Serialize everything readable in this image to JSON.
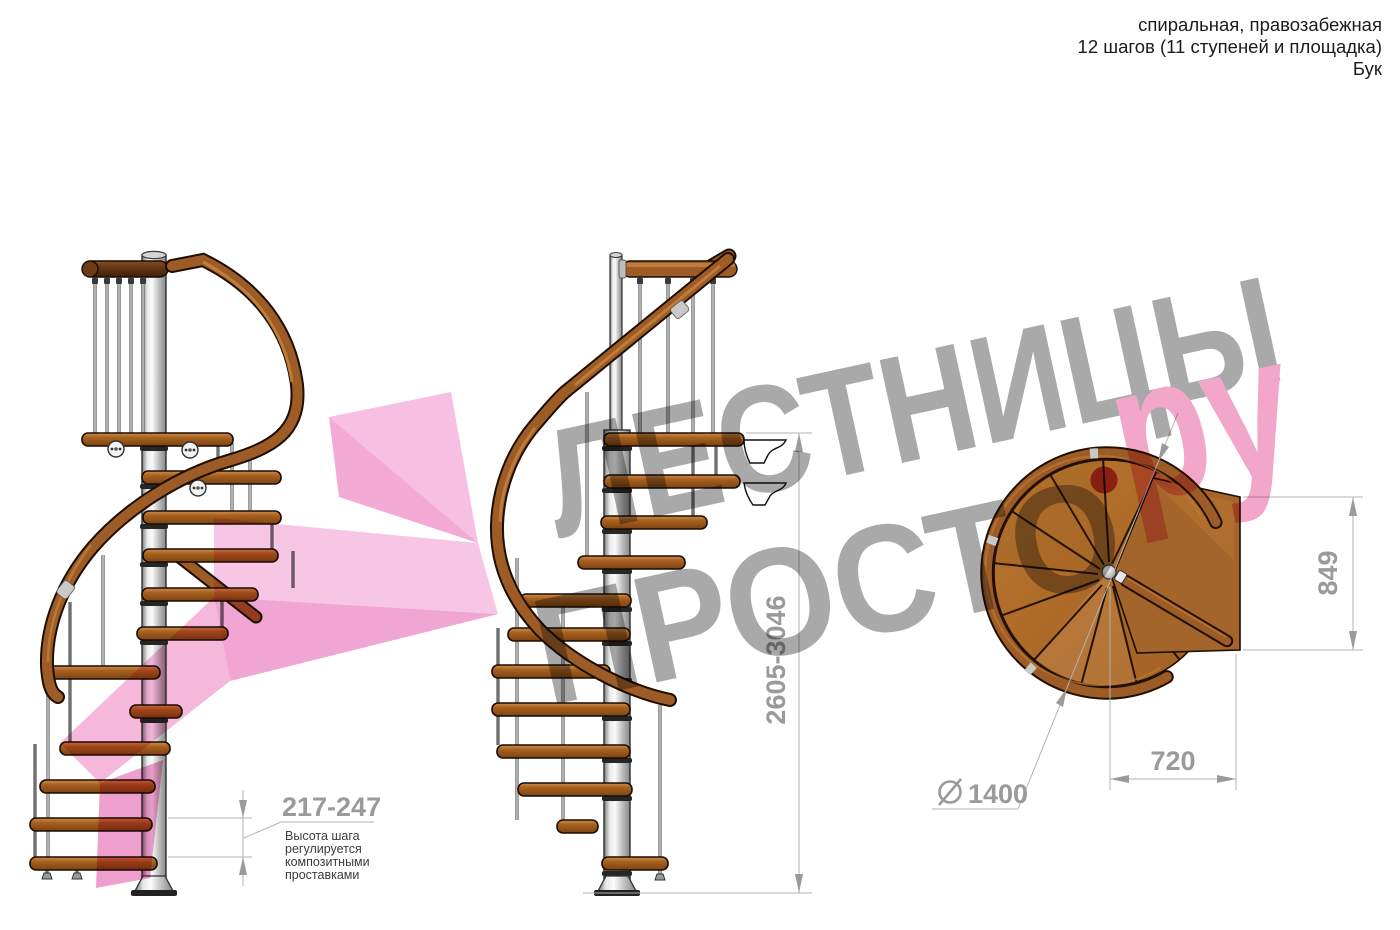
{
  "header": {
    "line1": "спиральная, правозабежная",
    "line2": "12 шагов (11 ступеней и площадка)",
    "line3": "Бук"
  },
  "watermark": {
    "word_top": "ЛЕСТНИЦЫ",
    "word_bottom": "ПРОСТО",
    "word_suffix": "ру"
  },
  "annotations": {
    "step_height": {
      "value": "217-247",
      "note": [
        "Высота шага",
        "регулируется",
        "композитными",
        "проставками"
      ]
    },
    "total_height": {
      "value": "2605-3046"
    },
    "landing_depth": {
      "value": "849"
    },
    "landing_width": {
      "value": "720"
    },
    "diameter": {
      "value": "1400"
    }
  },
  "colors": {
    "wood_step": "#a8601f",
    "handrail": "#9d5c26",
    "top_rail_dark": "#60globalThis",
    "pole": "#d9d9d9",
    "dim_line": "#b3b3b3",
    "dim_text": "#9a9a9a",
    "note_text": "#3b3b3b",
    "watermark_gray": "#a9a9a9",
    "watermark_pink": "#f2a6ca",
    "watermark_dot": "#c9466d",
    "arrow_pink": "#f3b4da"
  }
}
